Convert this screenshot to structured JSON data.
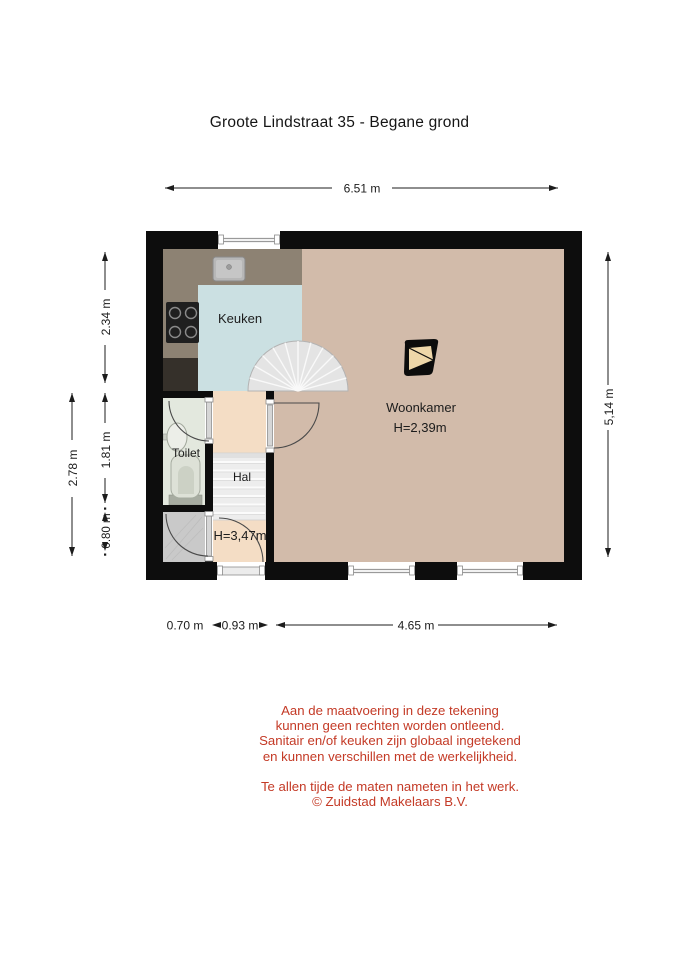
{
  "title": "Groote Lindstraat 35 - Begane grond",
  "plan": {
    "rooms": {
      "kitchen": {
        "label": "Keuken"
      },
      "living": {
        "label": "Woonkamer",
        "ceiling_height": "H=2,39m"
      },
      "toilet": {
        "label": "Toilet"
      },
      "hall": {
        "label": "Hal",
        "ceiling_height": "H=3,47m"
      }
    },
    "dimensions": {
      "width_total": "6.51 m",
      "height_right": "5,14 m",
      "left_outer": "2.78 m",
      "left_kitchen": "2.34 m",
      "left_toilet": "1.81 m",
      "left_closet": "0.80 m",
      "bottom_closet": "0.70 m",
      "bottom_hall": "0.93 m",
      "bottom_living": "4.65 m"
    },
    "icons": {
      "north_arrow": "north-arrow-icon"
    }
  },
  "colors": {
    "wall": "#0d0d0d",
    "living_floor": "#d2bbaa",
    "kitchen_floor": "#cbe0e2",
    "counter": "#8d8273",
    "cabinet": "#35302a",
    "toilet_floor": "#e3e8de",
    "hall_floor": "#f4ddc5",
    "closet_floor": "#c9c9c9",
    "stairs": "#e4e4e4",
    "north_fill": "#eed7a9",
    "dimension_text": "#1c1c1c",
    "disclaimer_text": "#c43a26"
  },
  "disclaimer": {
    "lines": [
      "Aan de maatvoering in deze tekening",
      "kunnen geen rechten worden ontleend.",
      "Sanitair en/of keuken zijn globaal ingetekend",
      "en kunnen verschillen met de werkelijkheid.",
      "Te allen tijde de maten nameten in het werk.",
      "© Zuidstad Makelaars B.V."
    ]
  }
}
